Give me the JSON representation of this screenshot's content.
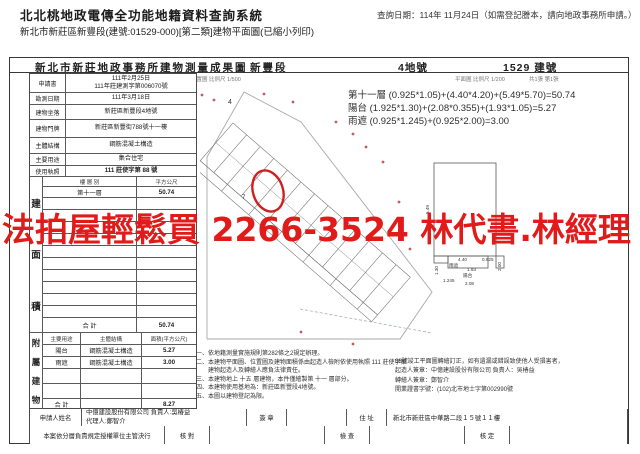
{
  "header": {
    "app_title": "北北桃地政電傳全功能地籍資料查詢系統",
    "query_date": "查詢日期：114年 11月24日（如需登記謄本，請向地政事務所申請。）",
    "subtitle": "新北市新莊區新豐段(建號:01529-000)[第二類]建物平面圖(已縮小列印)"
  },
  "doc": {
    "title": "新北市新莊地政事務所建物測量成果圖",
    "section_name": "新豐段",
    "lot_no": "4地號",
    "building_no": "1529 建號",
    "location_caption": "位置圖 比例尺 1/500",
    "plan_caption": "平面圖 比例尺 1/200",
    "sheet_caption": "共1張 第1張"
  },
  "info_table": {
    "rows": [
      {
        "label": "申請書",
        "value": "111年2月25日\n111年莊建測字第006070號"
      },
      {
        "label": "勘測日期",
        "value": "111年3月18日"
      },
      {
        "label": "建物坐落",
        "value": "新莊區新豐段4地號"
      },
      {
        "label": "建物門牌",
        "value": "新莊區新豐街788號十一樓"
      },
      {
        "label": "主體結構",
        "value": "鋼筋混凝土構造"
      },
      {
        "label": "主要用途",
        "value": "集合住宅"
      },
      {
        "label": "使用執照",
        "value": "111 莊使字第 88 號"
      }
    ]
  },
  "area_table": {
    "side_chars": [
      "建",
      "面",
      "積"
    ],
    "col_floor": "樓 層 別",
    "col_area": "平方公尺",
    "rows": [
      {
        "floor": "第十一層",
        "area": "50.74"
      }
    ],
    "total_label": "合  計",
    "total": "50.74"
  },
  "annex_table": {
    "side_chars": [
      "附",
      "屬",
      "建",
      "物"
    ],
    "col_use": "主要用途",
    "col_structure": "主體結構",
    "col_area": "面積(平方公尺)",
    "rows": [
      {
        "use": "陽台",
        "structure": "鋼筋混凝土構造",
        "area": "5.27"
      },
      {
        "use": "雨遮",
        "structure": "鋼筋混凝土構造",
        "area": "3.00"
      }
    ],
    "total_label": "合  計",
    "total": "8.27"
  },
  "formulas": [
    "第十一層 (0.925*1.05)+(4.40*4.20)+(5.49*5.70)=50.74",
    "陽台 (1.925*1.30)+(2.08*0.355)+(1.93*1.05)=5.27",
    "雨遮 (0.925*1.245)+(0.925*2.00)=3.00"
  ],
  "notes": [
    "一、依地籍測量實施規則第282條之2規定辦理。",
    "二、本建物平面圖、位置圖及建物面積係由起造人檢附依使用執照 111 莊使字第",
    "　　建物起造人及轉繪人應負法律責任。",
    "三、本建物地上 十五 層建物，本件僅繪製第 十一 層部分。",
    "四、本建物使用基地為：新莊區新豐段4地號。",
    "五、本圖以建物登記為限。"
  ],
  "sign_notes": [
    "88號竣工平面圖轉繪訂正，如有遺漏或錯誤致使他人受損害者，",
    "起造人簽章：中億建設股份有限公司 負責人：吳椿益",
    "轉繪人簽章：鄭智介",
    "開業證書字號：(102)北市地士字第002990號"
  ],
  "applicant_row": {
    "label": "申請人姓名",
    "value": "中億建設股份有限公司 負責人:吳椿益\n代理人:鄭智介",
    "sign_label": "簽  章",
    "addr_label": "住  址",
    "addr_value": "新北市新莊區中華路二段１５號１１樓"
  },
  "approval_row": {
    "label": "本案依分層負責規定授權單位主管決行",
    "check1": "核  對",
    "check2": "檢  查",
    "check3": "核  定"
  },
  "plan": {
    "lot_label": "4",
    "unit_label": "7"
  },
  "detail_plan": {
    "dims": {
      "left_h": "5.49",
      "w1": "4.40",
      "w2": "0.925",
      "d1": "1.93",
      "d2": "2.08",
      "d3": "1.245",
      "d4": "2.00",
      "d5": "1.30",
      "balcony": "陽台",
      "eave": "雨遮"
    }
  },
  "watermark": {
    "text": "法拍屋輕鬆買 2266-3524 林代書.林經理",
    "color": "#e11a1a"
  }
}
